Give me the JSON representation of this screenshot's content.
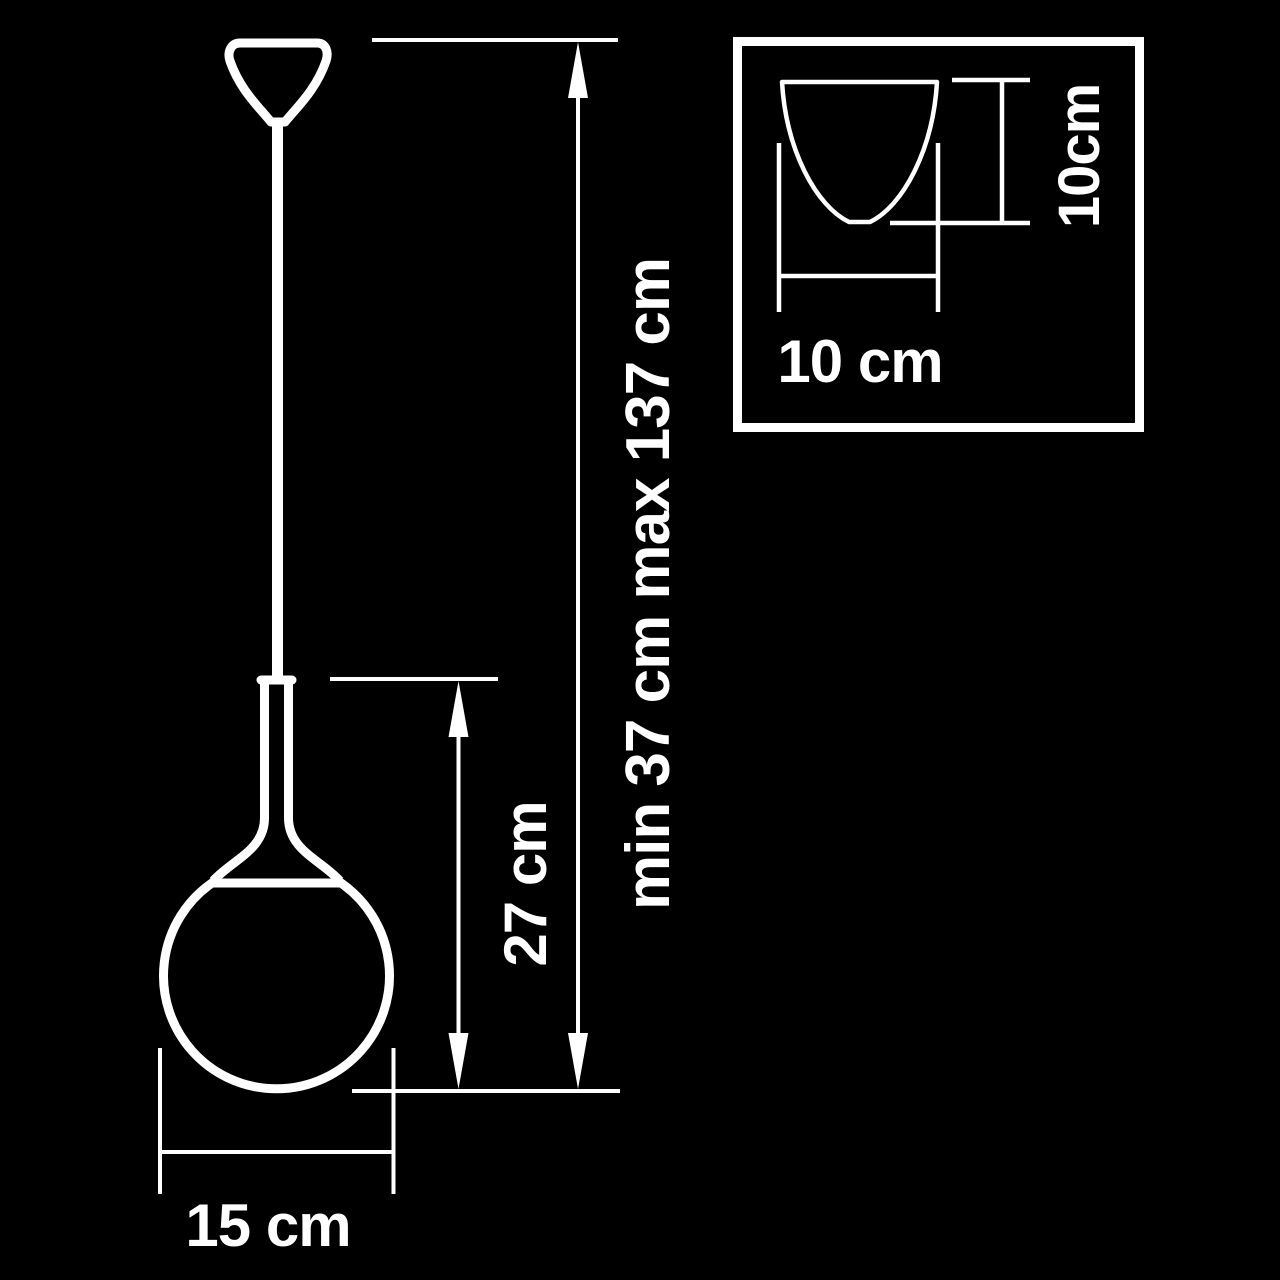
{
  "diagram": {
    "type": "product-dimension-diagram",
    "subject": "pendant lamp with globe shade",
    "colors": {
      "background": "#000000",
      "line": "#ffffff",
      "text": "#ffffff"
    },
    "main_view": {
      "suspension_height_label": "min 37 cm max 137 cm",
      "shade_height_label": "27 cm",
      "shade_diameter_label": "15 cm"
    },
    "inset_view": {
      "width_label": "10 cm",
      "height_label": "10cm"
    }
  }
}
